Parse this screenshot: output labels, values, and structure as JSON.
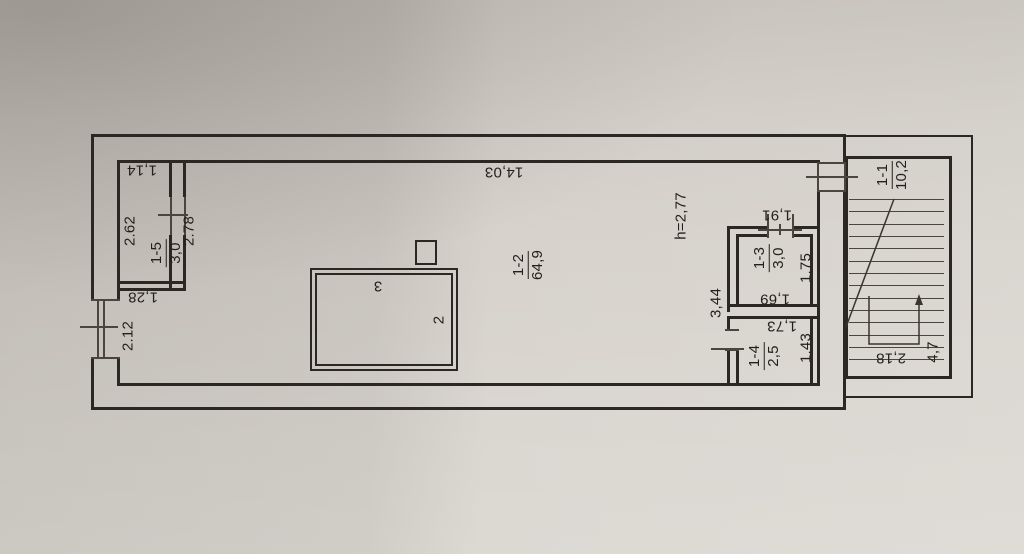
{
  "plan": {
    "rooms": {
      "r1_1": {
        "number": "1-1",
        "area": "10,2"
      },
      "r1_2": {
        "number": "1-2",
        "area": "64,9"
      },
      "r1_3": {
        "number": "1-3",
        "area": "3,0"
      },
      "r1_4": {
        "number": "1-4",
        "area": "2,5"
      },
      "r1_5": {
        "number": "1-5",
        "area": "3,0"
      }
    },
    "height_note": "h=2,77",
    "dimensions": {
      "total_width": "14,03",
      "r15_width": "1,14",
      "r15_length": "2.62",
      "r15_door_offset": "2.78",
      "pier_below_r15": "1,28",
      "left_window": "2.12",
      "mid_span": "3,44",
      "r13_door": "1,91",
      "r13_depth": "1.75",
      "r13_width": "1,69",
      "r14_width": "1,73",
      "r14_depth": "1.43",
      "stair_width": "2,18",
      "stair_length": "4,7"
    },
    "marks": {
      "m2": "2",
      "m3": "3"
    }
  }
}
